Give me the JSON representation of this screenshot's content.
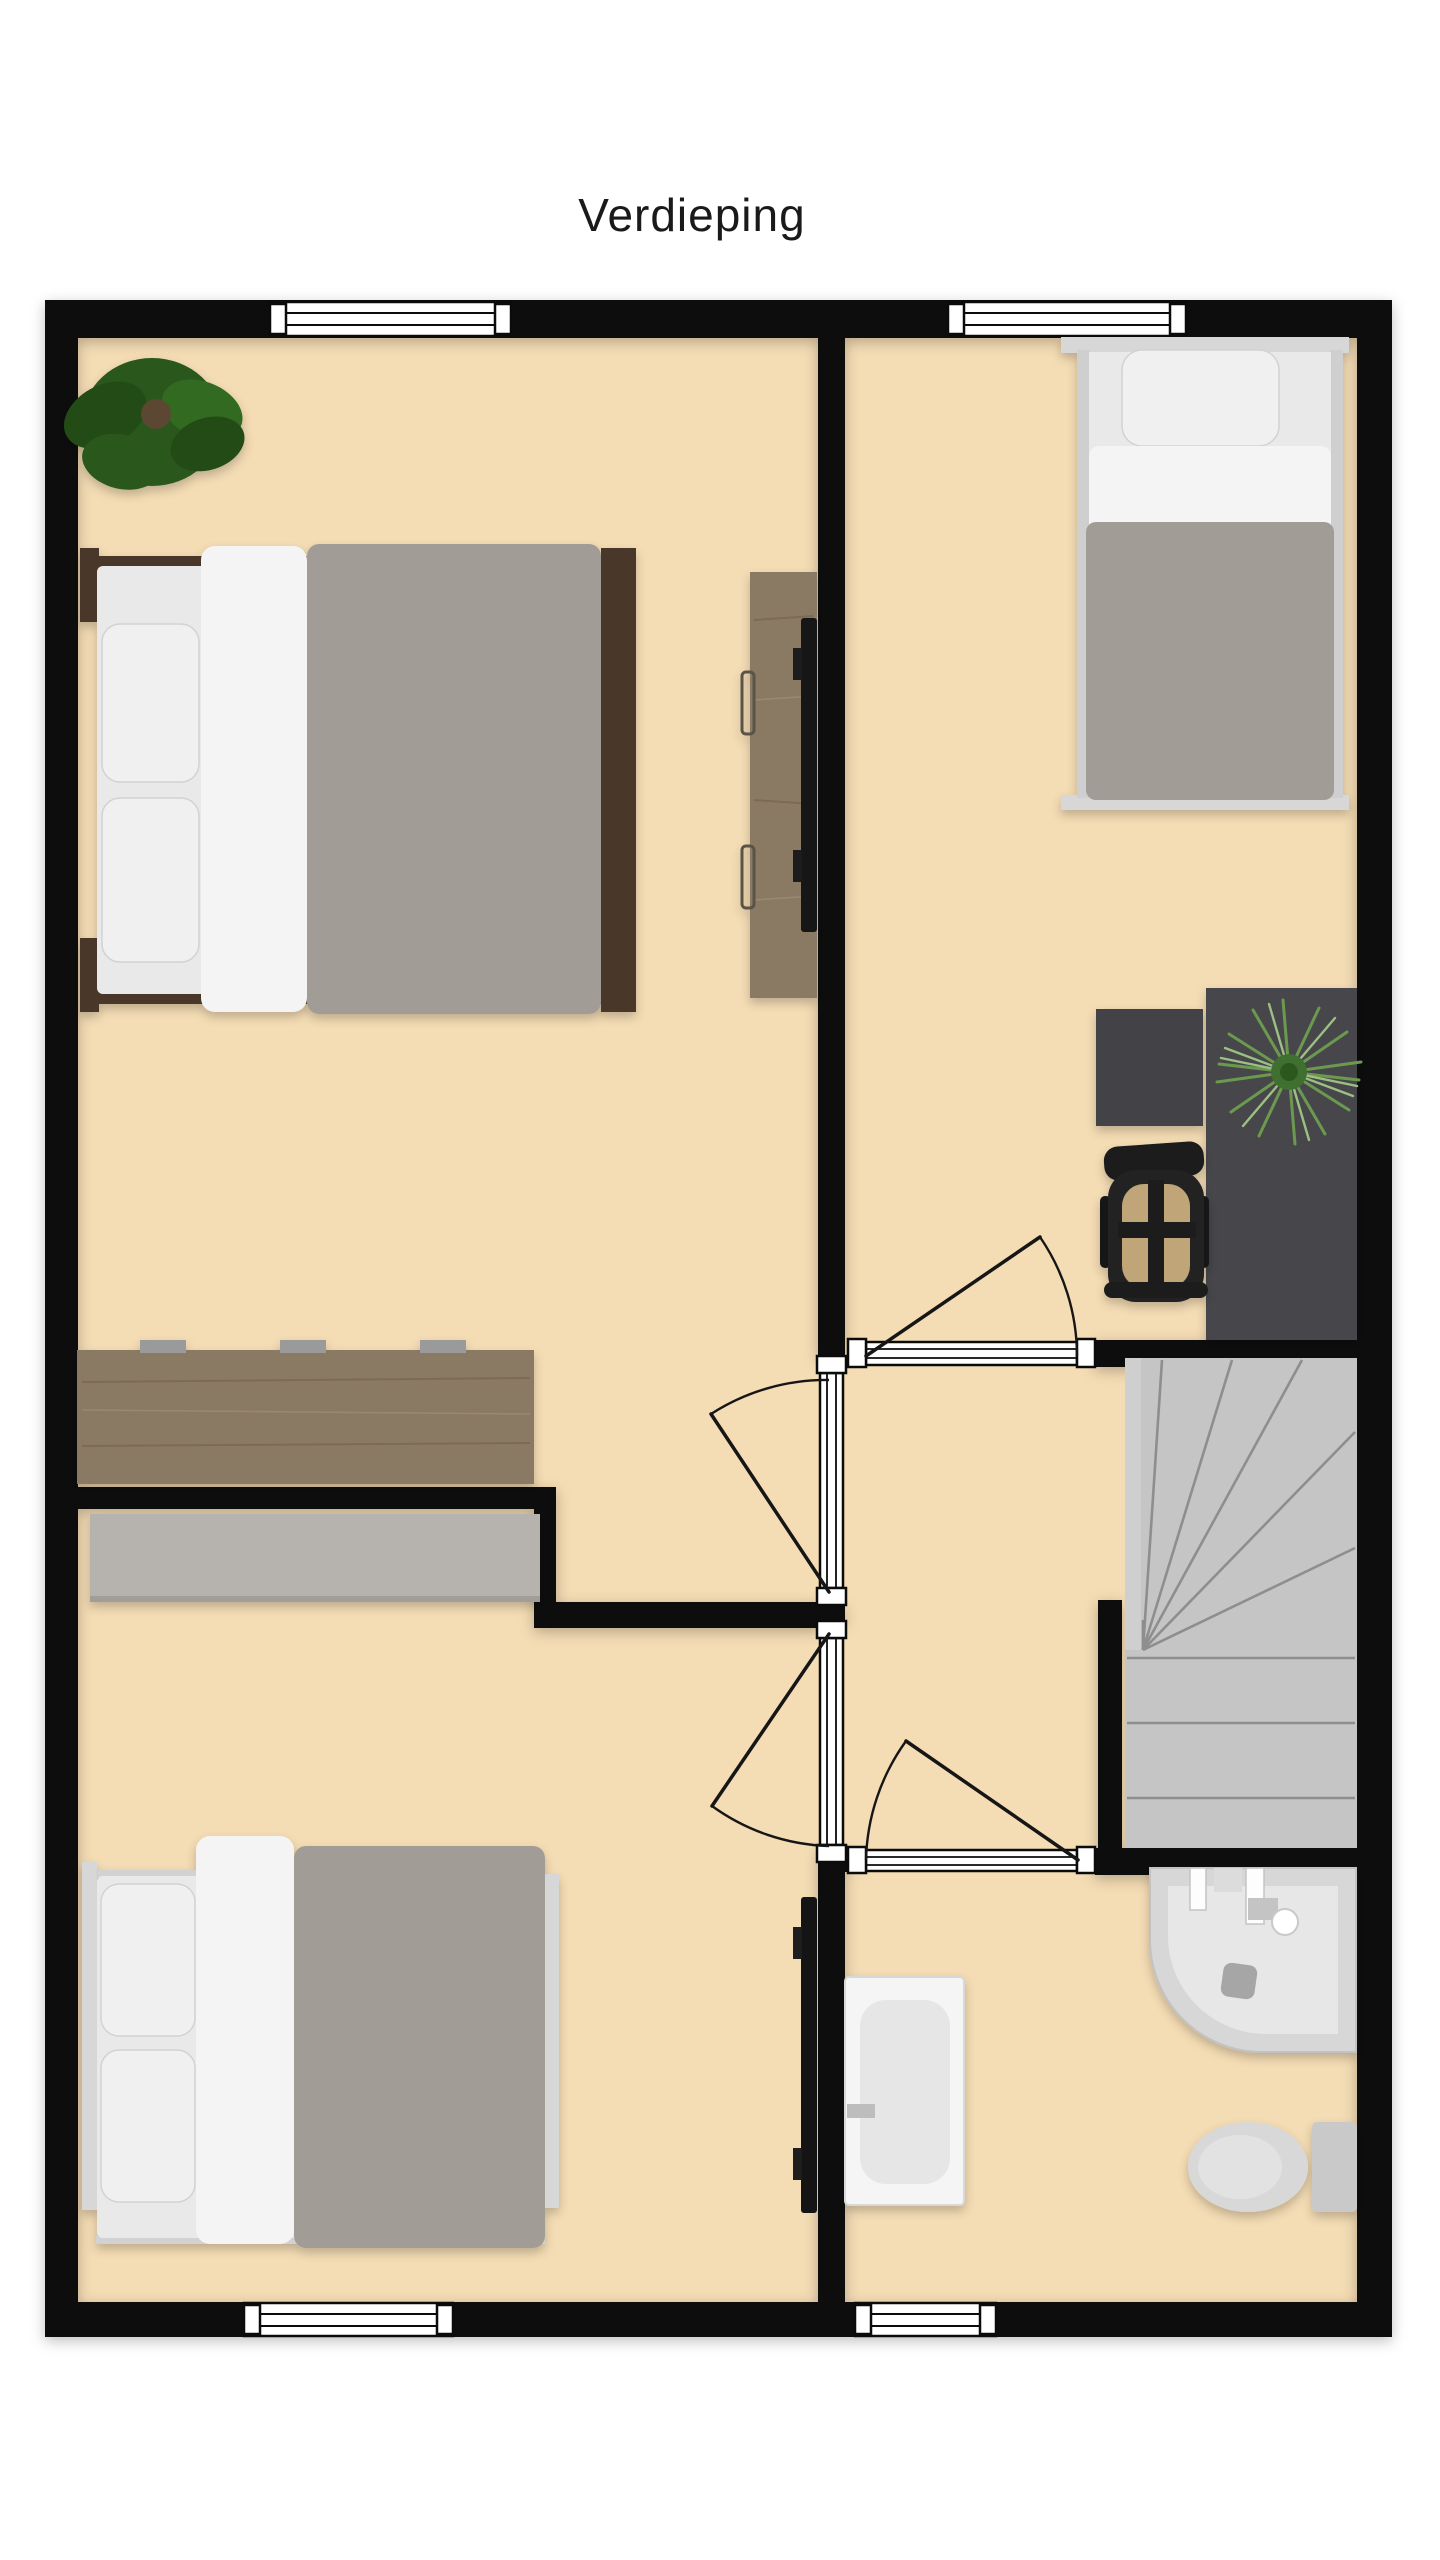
{
  "title": "Verdieping",
  "palette": {
    "title-color": "#1a1a1a",
    "floor": "#f4dcb4",
    "wall": "#0b0b0b",
    "stairs": "#c5c5c5",
    "stair-line": "#8e8e8e",
    "wood": "#8b7a63",
    "wardrobe": "#b6b3af",
    "desk-dark": "#47474b",
    "tv": "#141414",
    "bedframe-dark": "#4a392c",
    "bedframe-light": "#d7d7d7",
    "mattress": "#e9e9e9",
    "pillow": "#f0f0f0",
    "sheet": "#f4f4f4",
    "duvet": "#a29c97",
    "plant-dark": "#2c581f",
    "plant-spiky": "#6b9a4f",
    "chair": "#1c1c1a",
    "chair-seat": "#c0a579",
    "fixture": "#e6e6e6"
  },
  "plan": {
    "floor_name": "Verdieping",
    "rooms": [
      {
        "name": "bedroom-top-left",
        "objects": [
          "potted-plant",
          "double-bed",
          "wall-desk-with-tv",
          "sideboard"
        ]
      },
      {
        "name": "bedroom-top-right",
        "objects": [
          "single-bed",
          "desk",
          "desk-return",
          "office-chair",
          "desk-plant"
        ]
      },
      {
        "name": "bedroom-bottom-left",
        "objects": [
          "wardrobe",
          "double-bed",
          "wall-tv"
        ]
      },
      {
        "name": "landing",
        "objects": [
          "staircase"
        ]
      },
      {
        "name": "bathroom",
        "objects": [
          "bathtub",
          "corner-shower",
          "toilet"
        ]
      }
    ],
    "windows": [
      "top-wall-left",
      "top-wall-right",
      "bottom-wall-left",
      "bottom-wall-bathroom"
    ],
    "doors": [
      "bedroom-top-left-door",
      "bedroom-bottom-left-door",
      "bedroom-top-right-door",
      "bathroom-door"
    ]
  }
}
